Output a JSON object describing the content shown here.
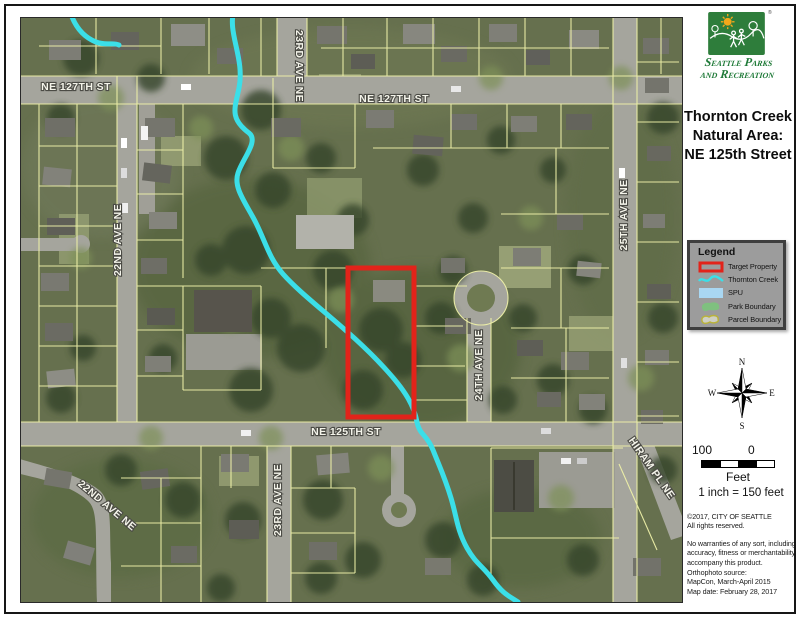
{
  "panel": {
    "logo": {
      "alt": "Seattle Parks and Recreation logo",
      "line1": "Seattle Parks",
      "line2": "and Recreation",
      "reg": "®"
    },
    "title": {
      "line1": "Thornton Creek",
      "line2": "Natural Area:",
      "line3": "NE 125th Street"
    },
    "legend": {
      "title": "Legend",
      "items": [
        {
          "label": "Target Property",
          "swatch": "red-rectangle-outline"
        },
        {
          "label": "Thornton Creek",
          "swatch": "cyan-creek-line"
        },
        {
          "label": "SPU",
          "swatch": "light-blue-fill"
        },
        {
          "label": "Park Boundary",
          "swatch": "green-area"
        },
        {
          "label": "Parcel Boundary",
          "swatch": "yellow-outline-parcel"
        }
      ]
    },
    "compass": {
      "n": "N",
      "e": "E",
      "s": "S",
      "w": "W"
    },
    "scale": {
      "left_value": "100",
      "right_value": "0",
      "unit": "Feet",
      "ratio": "1 inch = 150 feet"
    },
    "credits": {
      "copyright1": "©2017, CITY OF SEATTLE",
      "copyright2": "All rights reserved.",
      "warranty1": "No warranties of any sort, including",
      "warranty2": "accuracy, fitness or merchantability",
      "warranty3": "accompany this product.",
      "source1": "Orthophoto source:",
      "source2": "MapCon,  March-April 2015",
      "source3": "Map date: February 28, 2017"
    }
  },
  "map": {
    "labels": [
      {
        "text": "NE 127TH ST"
      },
      {
        "text": "NE 127TH ST"
      },
      {
        "text": "23RD AVE NE"
      },
      {
        "text": "22ND AVE NE"
      },
      {
        "text": "25TH AVE NE"
      },
      {
        "text": "24TH AVE NE"
      },
      {
        "text": "NE 125TH ST"
      },
      {
        "text": "23RD AVE NE"
      },
      {
        "text": "HIRAM PL NE"
      },
      {
        "text": "22ND AVE NE"
      }
    ]
  },
  "colors": {
    "creek": "#3BDFE8",
    "target_property": "#E2231A",
    "parcel_line": "#EDEFA8",
    "spu": "#A9D7F2",
    "park": "#7CC47C",
    "parcel_swatch_line": "#B9B23C",
    "parcel_swatch_fill": "#CFCFC3",
    "logo_green": "#2E7D3B",
    "road": "#A5A59D"
  }
}
